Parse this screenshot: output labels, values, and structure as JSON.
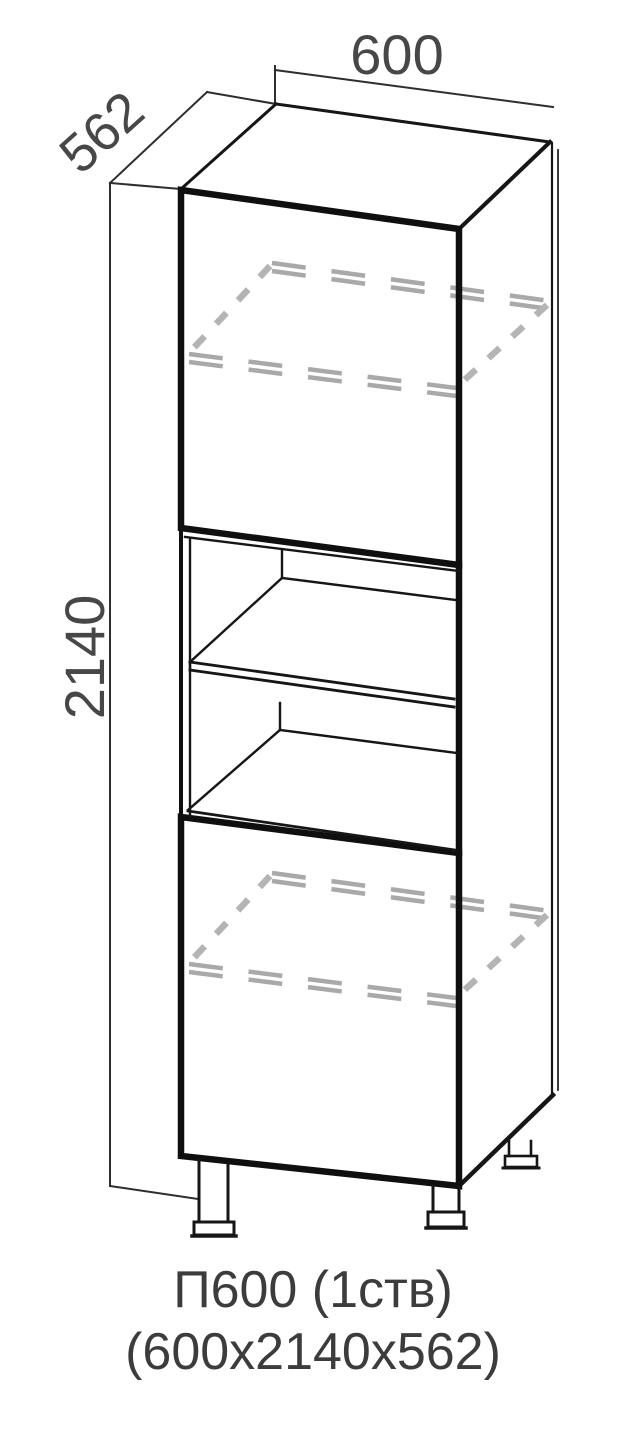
{
  "diagram": {
    "type": "furniture-technical-drawing",
    "product_caption": {
      "line1": "П600 (1ств)",
      "line2": "(600х2140х562)"
    },
    "dimensions": {
      "width_mm": "600",
      "height_mm": "2140",
      "depth_mm": "562"
    },
    "colors": {
      "background": "#ffffff",
      "outline": "#161616",
      "hidden_shelf_dash": "#a9a9a9",
      "dimension_text": "#474747",
      "caption_text": "#3c3c3c"
    }
  }
}
